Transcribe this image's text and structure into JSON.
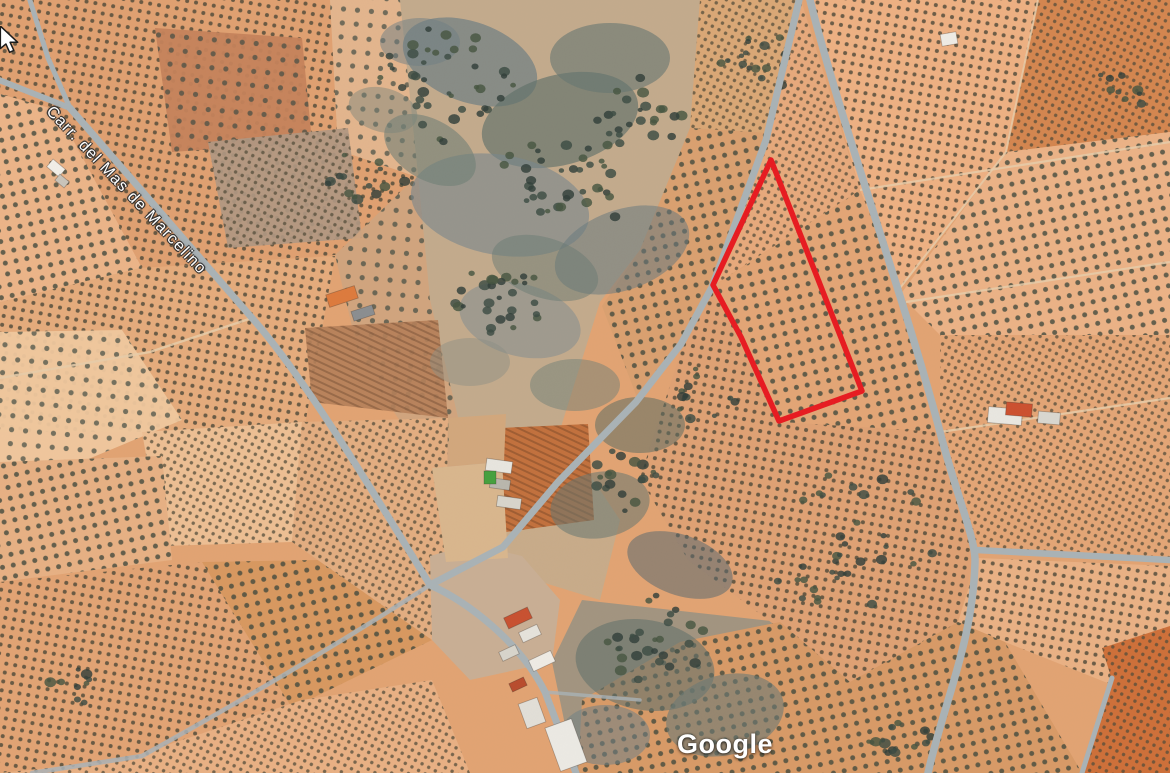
{
  "app": {
    "type": "google-maps-satellite-view"
  },
  "street_label": {
    "text": "Carr. del Mas de Marcelino"
  },
  "watermark": {
    "text": "Google"
  },
  "cursor": {
    "shape": "arrow-nw"
  },
  "parcel": {
    "name": "highlighted-parcel",
    "points": [
      [
        771,
        160
      ],
      [
        713,
        285
      ],
      [
        741,
        337
      ],
      [
        779,
        421
      ],
      [
        862,
        391
      ]
    ],
    "stroke": "#e8191f",
    "stroke_width": 5.5
  },
  "textures": [
    {
      "id": "dotsA",
      "size": 9,
      "rot": 10,
      "kind": "dots",
      "r": 2.0,
      "fill": "#4a4636",
      "op": 0.8
    },
    {
      "id": "dotsB",
      "size": 11,
      "rot": -12,
      "kind": "dots",
      "r": 2.5,
      "fill": "#41493c",
      "op": 0.8
    },
    {
      "id": "dotsC",
      "size": 7.5,
      "rot": 28,
      "kind": "dots",
      "r": 1.7,
      "fill": "#514b38",
      "op": 0.75
    },
    {
      "id": "dotsSparse",
      "size": 14,
      "rot": 5,
      "kind": "dots",
      "r": 2.6,
      "fill": "#3f4a42",
      "op": 0.7
    },
    {
      "id": "rowsA",
      "size": 6,
      "rot": 115,
      "kind": "lines",
      "sw": 2,
      "stroke": "rgba(70,40,22,0.28)"
    }
  ],
  "map": {
    "width": 1170,
    "height": 773,
    "base_color": "#e2a372",
    "road_color": "#a9b2b6",
    "path_color": "#e8cda9",
    "tree_colors": [
      "#3b4a42",
      "#46543f",
      "#2f3d38"
    ],
    "zones": [
      {
        "p": "0,0 400,0 418,175 335,255 140,268 57,110 0,94",
        "f": "#e0a070",
        "t": "dotsA"
      },
      {
        "p": "330,0 402,0 420,178 338,150",
        "f": "#e3b58d",
        "t": "dotsSparse"
      },
      {
        "p": "155,28 302,38 312,142 172,152",
        "f": "#c5825a",
        "t": "dotsSparse",
        "o": 0.95
      },
      {
        "p": "208,142 348,128 362,238 228,248",
        "f": "#b09781",
        "t": "dotsC",
        "o": 0.92
      },
      {
        "p": "0,94 57,110 142,268 62,332 0,302",
        "f": "#ecb488",
        "t": "dotsB"
      },
      {
        "p": "0,302 140,268 335,256 305,425 150,432 0,432",
        "f": "#e5ab7b",
        "t": "dotsA"
      },
      {
        "p": "0,332 122,330 182,420 62,470 0,462",
        "f": "#f0c89e",
        "t": "dotsSparse",
        "o": 0.95
      },
      {
        "p": "142,432 302,422 292,542 162,546",
        "f": "#edbf93",
        "t": "dotsC"
      },
      {
        "p": "0,462 162,456 172,560 0,582",
        "f": "#e7b083",
        "t": "dotsB"
      },
      {
        "p": "0,582 202,562 342,600 302,700 122,760 0,773",
        "f": "#e2a373",
        "t": "dotsA"
      },
      {
        "p": "202,562 430,558 432,640 292,708",
        "f": "#d8985f",
        "t": "dotsB"
      },
      {
        "p": "122,760 302,700 432,680 470,773 0,773",
        "f": "#e9b083",
        "t": "dotsC"
      },
      {
        "p": "335,255 418,175 430,300 470,468 432,470 360,360",
        "f": "#cfa47e",
        "t": "dotsSparse",
        "o": 0.9
      },
      {
        "p": "302,422 448,418 446,562 432,640 292,542",
        "f": "#e3ad80",
        "t": "dotsC"
      },
      {
        "p": "400,0 700,0 690,128 640,250 600,302 560,430 520,470 470,468 430,300 418,175",
        "f": "#c3aa8c"
      },
      {
        "p": "520,470 560,430 620,520 600,600 470,560 465,505",
        "f": "#c8ab89"
      },
      {
        "p": "582,600 780,622 780,773 575,773 552,662",
        "f": "#a2947f"
      },
      {
        "p": "700,0 801,0 768,138 690,128",
        "f": "#daa775",
        "t": "dotsC"
      },
      {
        "p": "640,250 690,128 770,133 712,287 683,342 638,400 602,306",
        "f": "#daa06f",
        "t": "dotsB"
      },
      {
        "p": "801,0 860,190 713,286 768,138",
        "f": "#e7a97b",
        "t": "dotsC"
      },
      {
        "p": "860,190 906,302 940,432 780,422 742,338 713,287",
        "f": "#e3a575",
        "t": "dotsB"
      },
      {
        "p": "940,432 976,548 958,622 850,682 768,620 688,560 640,478 684,342 713,287 742,338 780,422",
        "f": "#dfa173",
        "t": "dotsA"
      },
      {
        "p": "1038,0 1170,0 1170,132 1006,152",
        "f": "#d4854e",
        "t": "dotsC"
      },
      {
        "p": "806,0 1038,0 1006,152 900,288 860,190",
        "f": "#eeb082",
        "t": "dotsA"
      },
      {
        "p": "1006,152 1170,132 1170,335 940,335 900,295",
        "f": "#ecb286",
        "t": "dotsB"
      },
      {
        "p": "940,335 1170,335 1170,558 978,548 940,432",
        "f": "#e4a575",
        "t": "dotsC"
      },
      {
        "p": "978,558 1170,566 1170,692 1110,684 1005,642 958,622",
        "f": "#eab184",
        "t": "dotsA"
      },
      {
        "p": "958,622 1005,642 1082,773 578,773 582,700 680,642 780,622 850,682",
        "f": "#d89a66",
        "t": "dotsB"
      },
      {
        "p": "1102,648 1170,626 1170,773 1082,773 1112,680",
        "f": "#ce6f38",
        "t": "dotsC"
      },
      {
        "p": "430,556 472,544 522,556 560,600 552,662 470,680 432,640",
        "f": "#c9ae94"
      },
      {
        "p": "500,428 588,424 594,520 506,532",
        "f": "#c2703c",
        "t": "rowsA"
      },
      {
        "p": "305,328 438,320 448,418 312,402",
        "f": "#b57e58",
        "t": "rowsA",
        "o": 0.9
      },
      {
        "p": "448,418 506,414 504,462 450,466",
        "f": "#d2a77c"
      },
      {
        "p": "432,468 502,462 508,558 446,562",
        "f": "#d9b68d"
      }
    ],
    "scrub_blobs": [
      {
        "x": 470,
        "y": 62,
        "rx": 70,
        "ry": 40,
        "rot": 20,
        "f": "#6d7d82",
        "o": 0.7
      },
      {
        "x": 560,
        "y": 120,
        "rx": 80,
        "ry": 45,
        "rot": -15,
        "f": "#5f7068",
        "o": 0.65
      },
      {
        "x": 500,
        "y": 205,
        "rx": 90,
        "ry": 50,
        "rot": 10,
        "f": "#76868c",
        "o": 0.6
      },
      {
        "x": 610,
        "y": 58,
        "rx": 60,
        "ry": 35,
        "rot": 0,
        "f": "#64756f",
        "o": 0.6
      },
      {
        "x": 430,
        "y": 150,
        "rx": 50,
        "ry": 30,
        "rot": 30,
        "f": "#707f74",
        "o": 0.6
      },
      {
        "x": 622,
        "y": 250,
        "rx": 70,
        "ry": 40,
        "rot": -20,
        "f": "#68787d",
        "o": 0.55
      },
      {
        "x": 520,
        "y": 320,
        "rx": 62,
        "ry": 36,
        "rot": 15,
        "f": "#7b8a90",
        "o": 0.5
      },
      {
        "x": 575,
        "y": 385,
        "rx": 45,
        "ry": 26,
        "rot": 0,
        "f": "#6f7f76",
        "o": 0.5
      },
      {
        "x": 640,
        "y": 425,
        "rx": 45,
        "ry": 28,
        "rot": 0,
        "f": "#5d6d62",
        "o": 0.55
      },
      {
        "x": 600,
        "y": 505,
        "rx": 50,
        "ry": 33,
        "rot": -10,
        "f": "#66766f",
        "o": 0.55
      },
      {
        "x": 680,
        "y": 565,
        "rx": 55,
        "ry": 30,
        "rot": 20,
        "f": "#5a6a70",
        "o": 0.55
      },
      {
        "x": 645,
        "y": 665,
        "rx": 70,
        "ry": 45,
        "rot": 10,
        "f": "#62716b",
        "o": 0.6
      },
      {
        "x": 725,
        "y": 715,
        "rx": 60,
        "ry": 40,
        "rot": -15,
        "f": "#6b7a74",
        "o": 0.6
      },
      {
        "x": 605,
        "y": 735,
        "rx": 45,
        "ry": 30,
        "rot": 0,
        "f": "#707f85",
        "o": 0.55
      },
      {
        "x": 420,
        "y": 42,
        "rx": 40,
        "ry": 24,
        "rot": 0,
        "f": "#6e7e84",
        "o": 0.5
      },
      {
        "x": 383,
        "y": 110,
        "rx": 35,
        "ry": 22,
        "rot": 15,
        "f": "#75837b",
        "o": 0.45
      },
      {
        "x": 470,
        "y": 362,
        "rx": 40,
        "ry": 24,
        "rot": 0,
        "f": "#8a8f82",
        "o": 0.45
      },
      {
        "x": 545,
        "y": 268,
        "rx": 55,
        "ry": 30,
        "rot": 18,
        "f": "#6a7a72",
        "o": 0.5
      }
    ],
    "tree_clusters": [
      {
        "x": 432,
        "y": 80,
        "n": 40,
        "s": 95
      },
      {
        "x": 560,
        "y": 178,
        "n": 35,
        "s": 85
      },
      {
        "x": 500,
        "y": 298,
        "n": 28,
        "s": 70
      },
      {
        "x": 645,
        "y": 120,
        "n": 24,
        "s": 62
      },
      {
        "x": 618,
        "y": 478,
        "n": 18,
        "s": 50
      },
      {
        "x": 660,
        "y": 645,
        "n": 28,
        "s": 72
      },
      {
        "x": 822,
        "y": 582,
        "n": 14,
        "s": 62
      },
      {
        "x": 762,
        "y": 58,
        "n": 16,
        "s": 50
      },
      {
        "x": 362,
        "y": 182,
        "n": 14,
        "s": 46
      },
      {
        "x": 902,
        "y": 738,
        "n": 12,
        "s": 42
      },
      {
        "x": 1128,
        "y": 88,
        "n": 9,
        "s": 36
      },
      {
        "x": 82,
        "y": 688,
        "n": 9,
        "s": 40
      },
      {
        "x": 852,
        "y": 528,
        "n": 20,
        "s": 95
      },
      {
        "x": 705,
        "y": 395,
        "n": 12,
        "s": 40
      }
    ],
    "thin_paths": [
      {
        "d": "M 860,190 L 1170,142",
        "w": 2.2
      },
      {
        "d": "M 906,302 L 1170,262",
        "w": 2.2
      },
      {
        "d": "M 940,432 L 1170,398",
        "w": 2.2
      },
      {
        "d": "M 1038,0 L 1006,152",
        "w": 2
      },
      {
        "d": "M 252,318 L 150,352 L 0,378",
        "w": 2.4
      },
      {
        "d": "M 1006,152 L 900,288",
        "w": 2
      }
    ],
    "roads": [
      {
        "d": "M -6,78 L 70,108",
        "w": 6
      },
      {
        "d": "M 28,-6 L 48,58 L 70,108",
        "w": 5
      },
      {
        "d": "M 70,108 L 252,318 C 300,372 360,470 430,585",
        "w": 7
      },
      {
        "d": "M 801,-8 L 766,140 L 712,287 L 681,344 L 636,402 L 558,482 L 503,547 L 430,585",
        "w": 7
      },
      {
        "d": "M 808,-8 C 838,115 904,296 940,432 C 957,497 976,540 975,562 C 973,642 944,702 928,773",
        "w": 7.5
      },
      {
        "d": "M 976,550 L 1170,560",
        "w": 6.5
      },
      {
        "d": "M 430,585 C 468,602 520,642 545,692 L 576,773",
        "w": 7
      },
      {
        "d": "M 430,585 C 342,642 232,706 142,756 L 32,773",
        "w": 4.5,
        "o": 0.85
      },
      {
        "d": "M 1112,678 L 1082,773",
        "w": 5
      },
      {
        "d": "M 545,692 L 640,700",
        "w": 3.5,
        "o": 0.8
      }
    ],
    "buildings": [
      {
        "x": 327,
        "y": 290,
        "w": 30,
        "h": 13,
        "rot": -18,
        "f": "#dd7a3c"
      },
      {
        "x": 352,
        "y": 308,
        "w": 22,
        "h": 10,
        "rot": -18,
        "f": "#8a8d90"
      },
      {
        "x": 48,
        "y": 163,
        "w": 16,
        "h": 10,
        "rot": 40,
        "f": "#f2efe8"
      },
      {
        "x": 56,
        "y": 177,
        "w": 12,
        "h": 8,
        "rot": 40,
        "f": "#c9c4ba"
      },
      {
        "x": 486,
        "y": 460,
        "w": 26,
        "h": 12,
        "rot": 8,
        "f": "#e8e6df"
      },
      {
        "x": 490,
        "y": 479,
        "w": 20,
        "h": 10,
        "rot": 8,
        "f": "#b9b6ad"
      },
      {
        "x": 497,
        "y": 497,
        "w": 24,
        "h": 11,
        "rot": 8,
        "f": "#d8d5cc"
      },
      {
        "x": 484,
        "y": 471,
        "w": 12,
        "h": 13,
        "rot": 0,
        "f": "#44a03c"
      },
      {
        "x": 988,
        "y": 408,
        "w": 34,
        "h": 16,
        "rot": 5,
        "f": "#e9e7e1"
      },
      {
        "x": 1006,
        "y": 403,
        "w": 26,
        "h": 13,
        "rot": 5,
        "f": "#cc4f2e"
      },
      {
        "x": 1038,
        "y": 412,
        "w": 22,
        "h": 12,
        "rot": 5,
        "f": "#d9d7d0"
      },
      {
        "x": 941,
        "y": 33,
        "w": 16,
        "h": 12,
        "rot": -10,
        "f": "#efece5"
      },
      {
        "x": 505,
        "y": 612,
        "w": 26,
        "h": 12,
        "rot": -25,
        "f": "#c8502f"
      },
      {
        "x": 520,
        "y": 628,
        "w": 20,
        "h": 11,
        "rot": -25,
        "f": "#e6e3dc"
      },
      {
        "x": 500,
        "y": 648,
        "w": 18,
        "h": 10,
        "rot": -25,
        "f": "#d8d5cc"
      },
      {
        "x": 530,
        "y": 655,
        "w": 24,
        "h": 12,
        "rot": -25,
        "f": "#efece5"
      },
      {
        "x": 510,
        "y": 680,
        "w": 16,
        "h": 9,
        "rot": -25,
        "f": "#b84b2c"
      },
      {
        "x": 522,
        "y": 700,
        "w": 20,
        "h": 26,
        "rot": -20,
        "f": "#e2dfd8"
      },
      {
        "x": 552,
        "y": 722,
        "w": 28,
        "h": 46,
        "rot": -20,
        "f": "#eceae4"
      }
    ]
  }
}
